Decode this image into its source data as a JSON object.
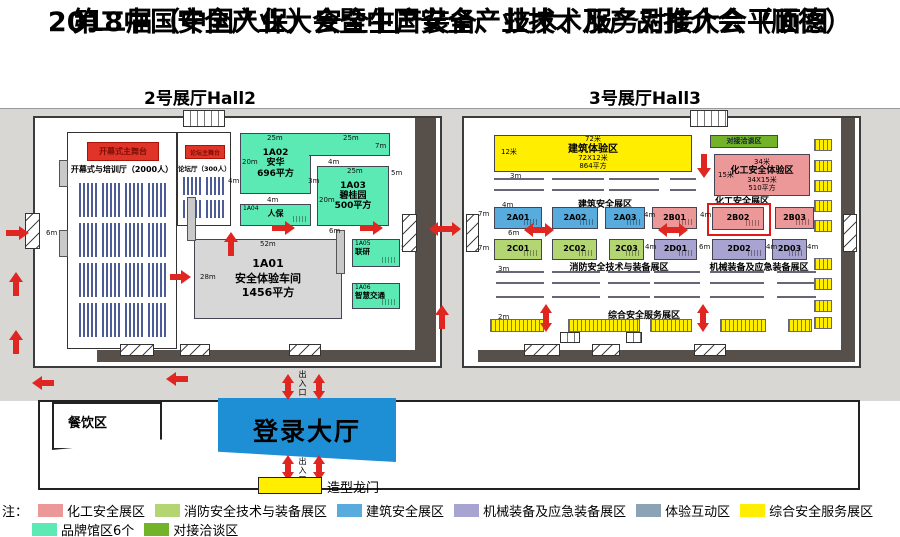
{
  "title": {
    "line1": "2018中国安全产业大会暨中国安全产业技术及产品推介会（顺德）",
    "line2": "第二届（中国人保）安全生产装备、技术、服务对接大会平面图"
  },
  "hall2": {
    "label": "2号展厅Hall2",
    "main_stage": "开幕式主舞台",
    "training_hall": "开幕式与培训厅（2000人）",
    "forum_stage": "论坛主舞台",
    "forum_hall": "论坛厅（300人）",
    "booths": {
      "a02": {
        "id": "1A02",
        "name": "安华",
        "area": "696平方"
      },
      "a03": {
        "id": "1A03",
        "name": "碧桂园",
        "area": "500平方"
      },
      "a04": {
        "id": "1A04",
        "name": "人保"
      },
      "a01": {
        "id": "1A01",
        "name": "安全体验车间",
        "area": "1456平方"
      },
      "a05": {
        "id": "1A05",
        "name": "联研"
      },
      "a06": {
        "id": "1A06",
        "name": "智慧交通"
      }
    }
  },
  "hall3": {
    "label": "3号展厅Hall3",
    "building_experience": {
      "dim_top": "72米",
      "name": "建筑体验区",
      "size": "72X12米",
      "area": "864平方",
      "dim_left": "12米"
    },
    "negotiation_zone": "对接洽谈区",
    "chemical_experience": {
      "dim_top": "34米",
      "name": "化工安全体验区",
      "size": "34X15米",
      "area": "510平方",
      "dim_left": "15米"
    },
    "sections": {
      "building": "建筑安全展区",
      "chemical": "化工安全展区",
      "fire": "消防安全技术与装备展区",
      "machinery": "机械装备及应急装备展区",
      "comprehensive": "综合安全服务展区"
    },
    "row1": [
      "2A01",
      "2A02",
      "2A03",
      "2B01",
      "2B02",
      "2B03"
    ],
    "row2": [
      "2C01",
      "2C02",
      "2C03",
      "2D01",
      "2D02",
      "2D03"
    ]
  },
  "site": {
    "dining": "餐饮区",
    "lobby": "登录大厅",
    "entrance": "出入口",
    "gate": "造型龙门"
  },
  "dims": {
    "m2": "2m",
    "m3": "3m",
    "m4": "4m",
    "m5": "5m",
    "m6": "6m",
    "m7": "7m",
    "m20": "20m",
    "m25": "25m",
    "m28": "28m",
    "m52": "52m"
  },
  "legend": {
    "prefix": "注：",
    "items": [
      {
        "label": "化工安全展区",
        "color": "#ec9898"
      },
      {
        "label": "消防安全技术与装备展区",
        "color": "#b4d672"
      },
      {
        "label": "建筑安全展区",
        "color": "#58abdd"
      },
      {
        "label": "机械装备及应急装备展区",
        "color": "#a8a4d2"
      },
      {
        "label": "体验互动区",
        "color": "#8ba3b5"
      },
      {
        "label": "综合安全服务展区",
        "color": "#ffee00"
      },
      {
        "label": "品牌馆区6个",
        "color": "#5beab4"
      },
      {
        "label": "对接洽谈区",
        "color": "#72b32a"
      }
    ]
  },
  "colors": {
    "stage_red": "#e03428",
    "wall": "#57504a",
    "lobby_blue": "#1f8fd5",
    "arrow_red": "#e02621"
  }
}
